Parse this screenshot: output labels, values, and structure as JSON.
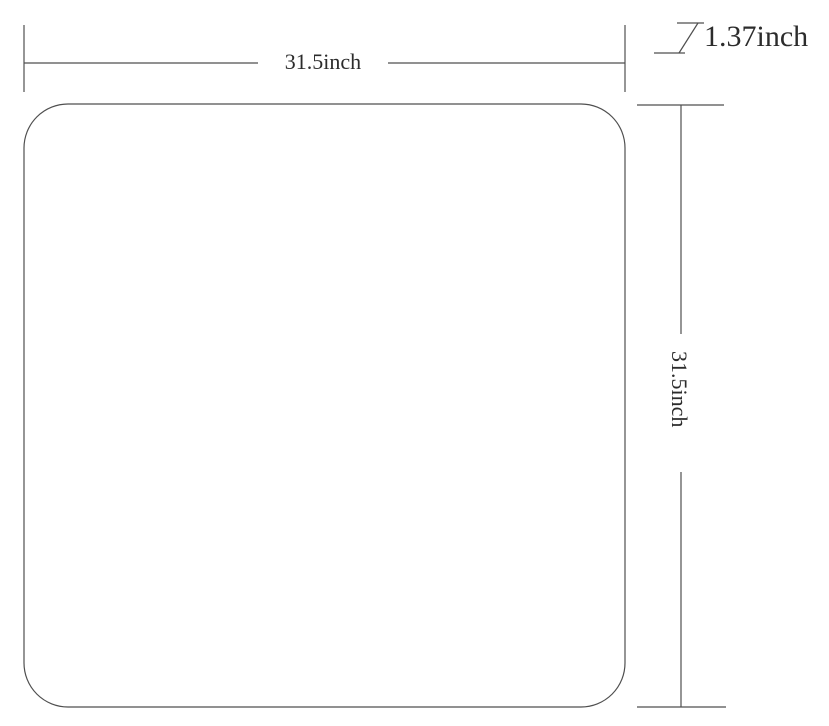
{
  "diagram": {
    "title": "rounded-square panel dimension drawing",
    "dimensions": {
      "width": {
        "label": "31.5inch"
      },
      "height": {
        "label": "31.5inch"
      },
      "thickness": {
        "label": "1.37inch"
      }
    },
    "colors": {
      "line": "#4f4f4f",
      "text": "#2c2c2c",
      "background": "#ffffff"
    }
  }
}
